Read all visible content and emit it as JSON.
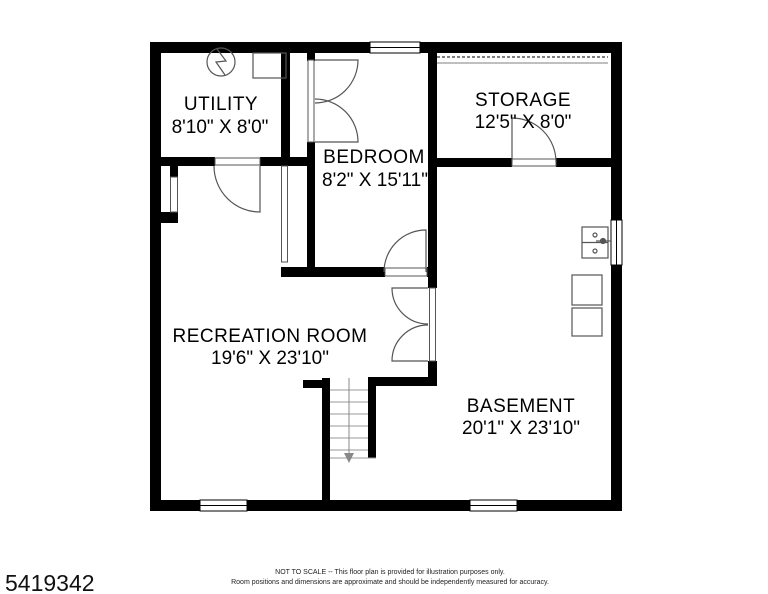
{
  "rooms": [
    {
      "name": "UTILITY",
      "dims": "8'10\" X 8'0\""
    },
    {
      "name": "STORAGE",
      "dims": "12'5\" X 8'0\""
    },
    {
      "name": "BEDROOM",
      "dims": "8'2\" X 15'11\""
    },
    {
      "name": "RECREATION ROOM",
      "dims": "19'6\" X 23'10\""
    },
    {
      "name": "BASEMENT",
      "dims": "20'1\" X 23'10\""
    }
  ],
  "footer": {
    "listing_id": "5419342",
    "disclaimer_line1": "NOT TO SCALE -- This floor plan is provided for illustration purposes only.",
    "disclaimer_line2": "Room positions and dimensions are approximate and should be independently measured for accuracy."
  },
  "colors": {
    "wall": "#000000",
    "thin_line": "#555555",
    "tread_line": "#999999",
    "background": "#ffffff",
    "text": "#000000"
  },
  "icons": {
    "utility_circle": "electrical-panel-icon",
    "stairs_arrow": "stairs-down-arrow-icon",
    "sink": "double-basin-sink-icon",
    "appliances": "washer-dryer-icon"
  }
}
